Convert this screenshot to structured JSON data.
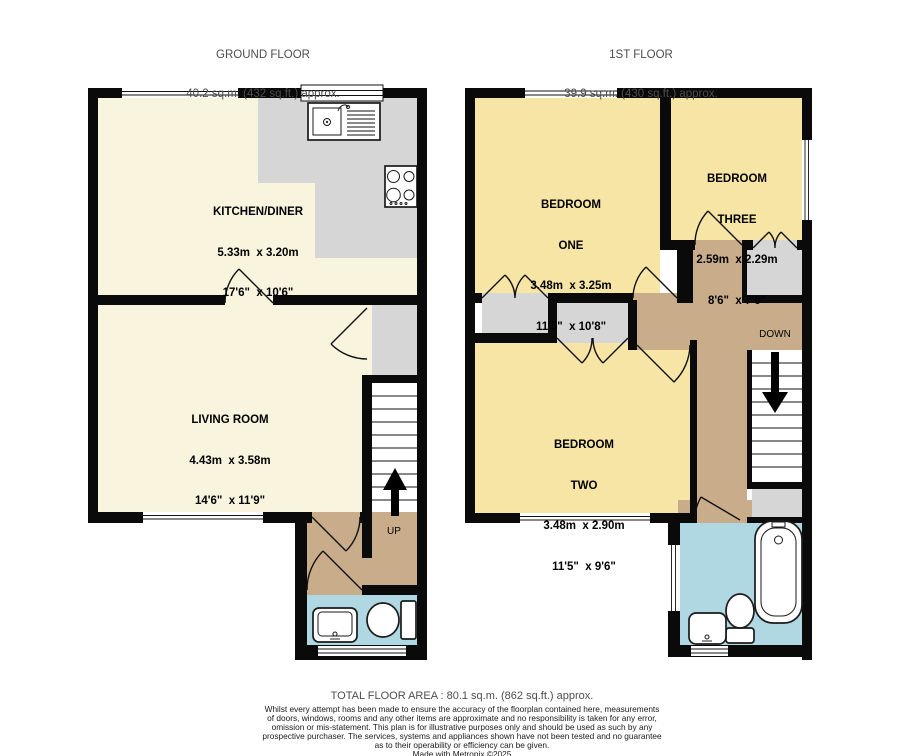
{
  "page": {
    "type": "property-floorplan"
  },
  "colors": {
    "wall": "#0a0a0a",
    "cream": "#f8f4de",
    "yellow": "#f7e5a5",
    "tan": "#c9ad8a",
    "blue": "#afd8e2",
    "gray": "#d6d6d6",
    "muted": "#4d4d4d",
    "bg": "#ffffff"
  },
  "floors": {
    "ground": {
      "title": "GROUND FLOOR",
      "area": "40.2 sq.m. (432 sq.ft.) approx.",
      "rooms": {
        "kitchen_diner": {
          "name": "KITCHEN/DINER",
          "metric": "5.33m  x 3.20m",
          "imperial": "17'6\"  x 10'6\""
        },
        "living_room": {
          "name": "LIVING ROOM",
          "metric": "4.43m  x 3.58m",
          "imperial": "14'6\"  x 11'9\""
        }
      },
      "stairs_label": "UP"
    },
    "first": {
      "title": "1ST FLOOR",
      "area": "39.9 sq.m. (430 sq.ft.) approx.",
      "rooms": {
        "bedroom_one": {
          "line1": "BEDROOM",
          "line2": "ONE",
          "metric": "3.48m  x 3.25m",
          "imperial": "11'5\"  x 10'8\""
        },
        "bedroom_three": {
          "line1": "BEDROOM",
          "line2": "THREE",
          "metric": "2.59m  x 2.29m",
          "imperial": "8'6\"  x 7'6\""
        },
        "bedroom_two": {
          "line1": "BEDROOM",
          "line2": "TWO",
          "metric": "3.48m  x 2.90m",
          "imperial": "11'5\"  x 9'6\""
        }
      },
      "stairs_label": "DOWN"
    }
  },
  "footer": {
    "total_area": "TOTAL FLOOR AREA : 80.1 sq.m. (862 sq.ft.) approx.",
    "disclaimer_lines": [
      "Whilst every attempt has been made to ensure the accuracy of the floorplan contained here, measurements",
      "of doors, windows, rooms and any other items are approximate and no responsibility is taken for any error,",
      "omission or mis-statement. This plan is for illustrative purposes only and should be used as such by any",
      "prospective purchaser. The services, systems and appliances shown have not been tested and no guarantee",
      "as to their operability or efficiency can be given.",
      "Made with Metropix ©2025"
    ]
  }
}
